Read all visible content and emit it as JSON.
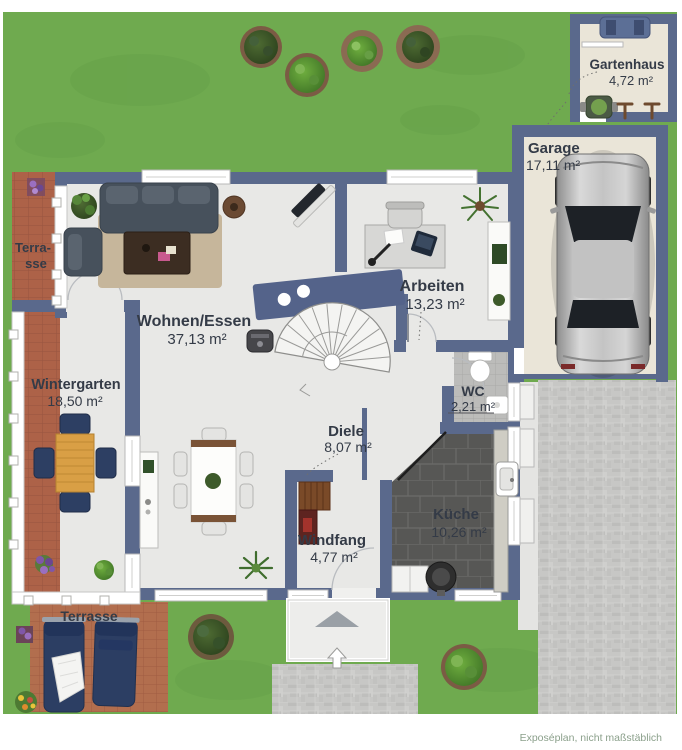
{
  "plan": {
    "footer_note": "Exposéplan, nicht maßstäblich",
    "rooms": {
      "gartenhaus": {
        "name": "Gartenhaus",
        "area": "4,72 m²"
      },
      "garage": {
        "name": "Garage",
        "area": "17,11 m²"
      },
      "terrasse_left": {
        "name_line1": "Terra-",
        "name_line2": "sse"
      },
      "wohnen_essen": {
        "name": "Wohnen/Essen",
        "area": "37,13 m²"
      },
      "arbeiten": {
        "name": "Arbeiten",
        "area": "13,23 m²"
      },
      "wintergarten": {
        "name": "Wintergarten",
        "area": "18,50 m²"
      },
      "wc": {
        "name": "WC",
        "area": "2,21 m²"
      },
      "diele": {
        "name": "Diele",
        "area": "8,07 m²"
      },
      "windfang": {
        "name": "Windfang",
        "area": "4,77 m²"
      },
      "kueche": {
        "name": "Küche",
        "area": "10,26 m²"
      },
      "terrasse_bottom": {
        "name": "Terrasse"
      }
    },
    "colors": {
      "wall": "#5a698c",
      "lawn": "#6faa4f",
      "interior_floor": "#e8e8e6",
      "garage_floor": "#eae5d8",
      "terracotta": "#ad6248",
      "kitchen_tile": "#575755",
      "paving": "#c7c7c5",
      "label_text": "#343b47",
      "footer_text": "#8ba08b"
    }
  }
}
